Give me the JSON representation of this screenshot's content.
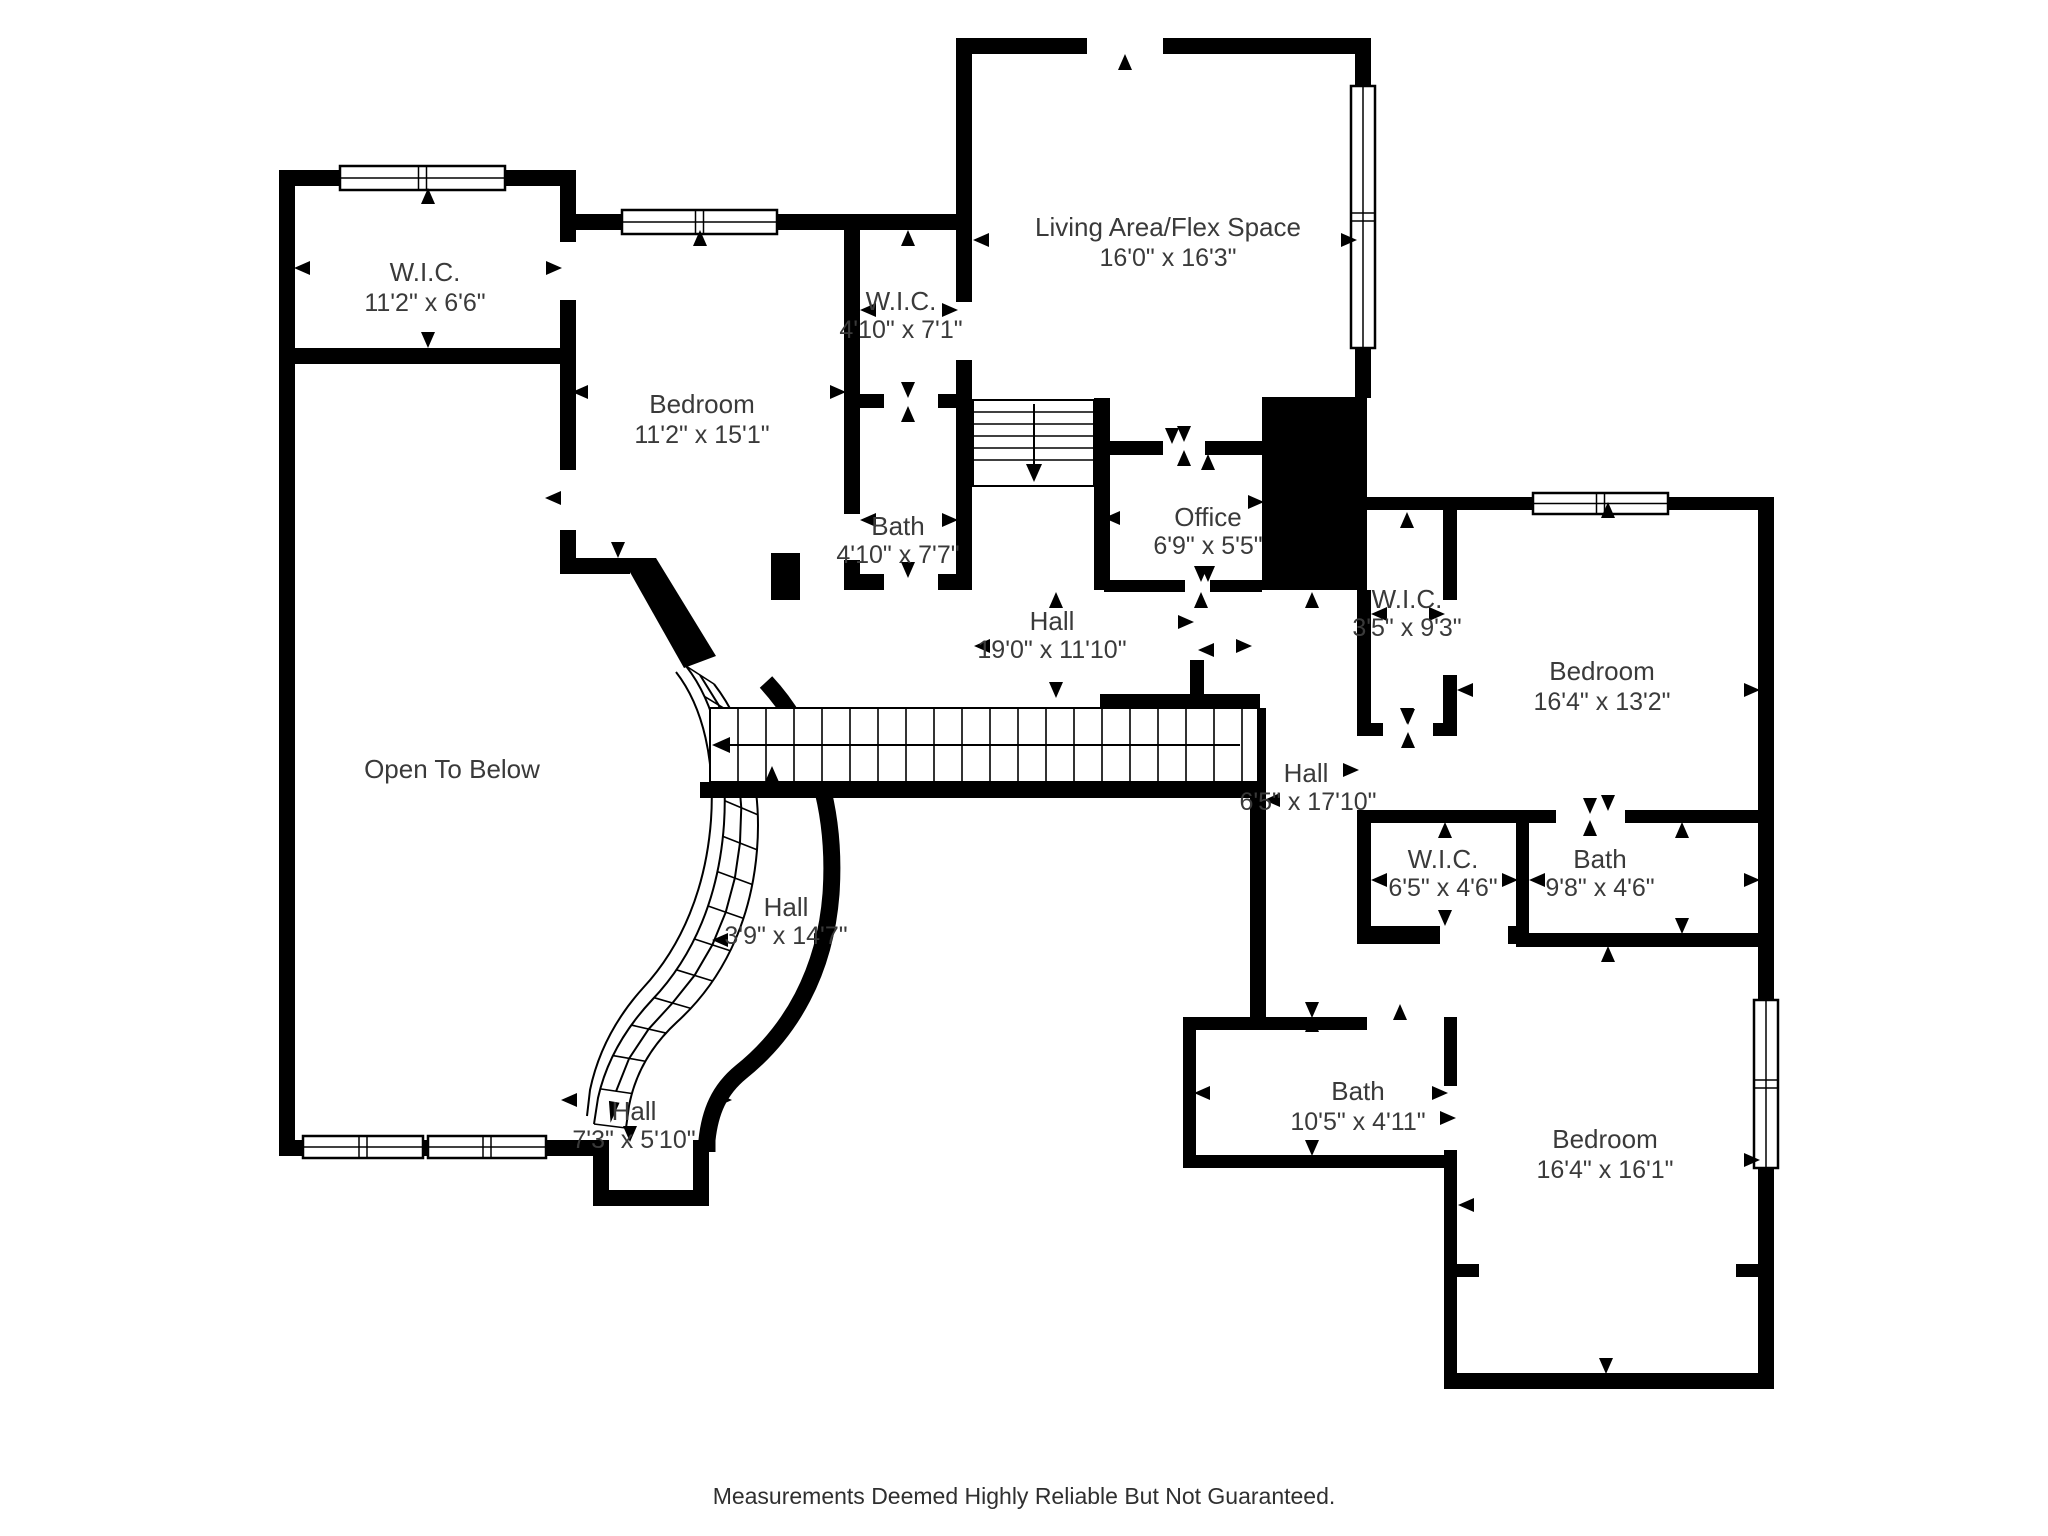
{
  "footer": {
    "disclaimer": "Measurements Deemed Highly Reliable But Not Guaranteed."
  },
  "colors": {
    "wall": "#000000",
    "floor": "#ffffff",
    "label": "#3a3a3a"
  },
  "rooms": {
    "wic_top_left": {
      "name": "W.I.C.",
      "dims": "11'2\" x 6'6\""
    },
    "bedroom_top_left": {
      "name": "Bedroom",
      "dims": "11'2\" x 15'1\""
    },
    "wic_top_mid": {
      "name": "W.I.C.",
      "dims": "4'10\" x 7'1\""
    },
    "living_area": {
      "name": "Living Area/Flex Space",
      "dims": "16'0\" x 16'3\""
    },
    "bath_mid": {
      "name": "Bath",
      "dims": "4'10\" x 7'7\""
    },
    "office": {
      "name": "Office",
      "dims": "6'9\" x 5'5\""
    },
    "hall_main": {
      "name": "Hall",
      "dims": "19'0\" x 11'10\""
    },
    "wic_right": {
      "name": "W.I.C.",
      "dims": "3'5\" x 9'3\""
    },
    "bedroom_right": {
      "name": "Bedroom",
      "dims": "16'4\" x 13'2\""
    },
    "open_to_below": {
      "name": "Open To Below",
      "dims": ""
    },
    "hall_right": {
      "name": "Hall",
      "dims": "6'5\" x 17'10\""
    },
    "wic_small": {
      "name": "W.I.C.",
      "dims": "6'5\" x 4'6\""
    },
    "bath_right": {
      "name": "Bath",
      "dims": "9'8\" x 4'6\""
    },
    "hall_curved": {
      "name": "Hall",
      "dims": "3'9\" x 14'7\""
    },
    "hall_bottom": {
      "name": "Hall",
      "dims": "7'3\" x 5'10\""
    },
    "bath_bottom": {
      "name": "Bath",
      "dims": "10'5\" x 4'11\""
    },
    "bedroom_bottom": {
      "name": "Bedroom",
      "dims": "16'4\" x 16'1\""
    }
  }
}
